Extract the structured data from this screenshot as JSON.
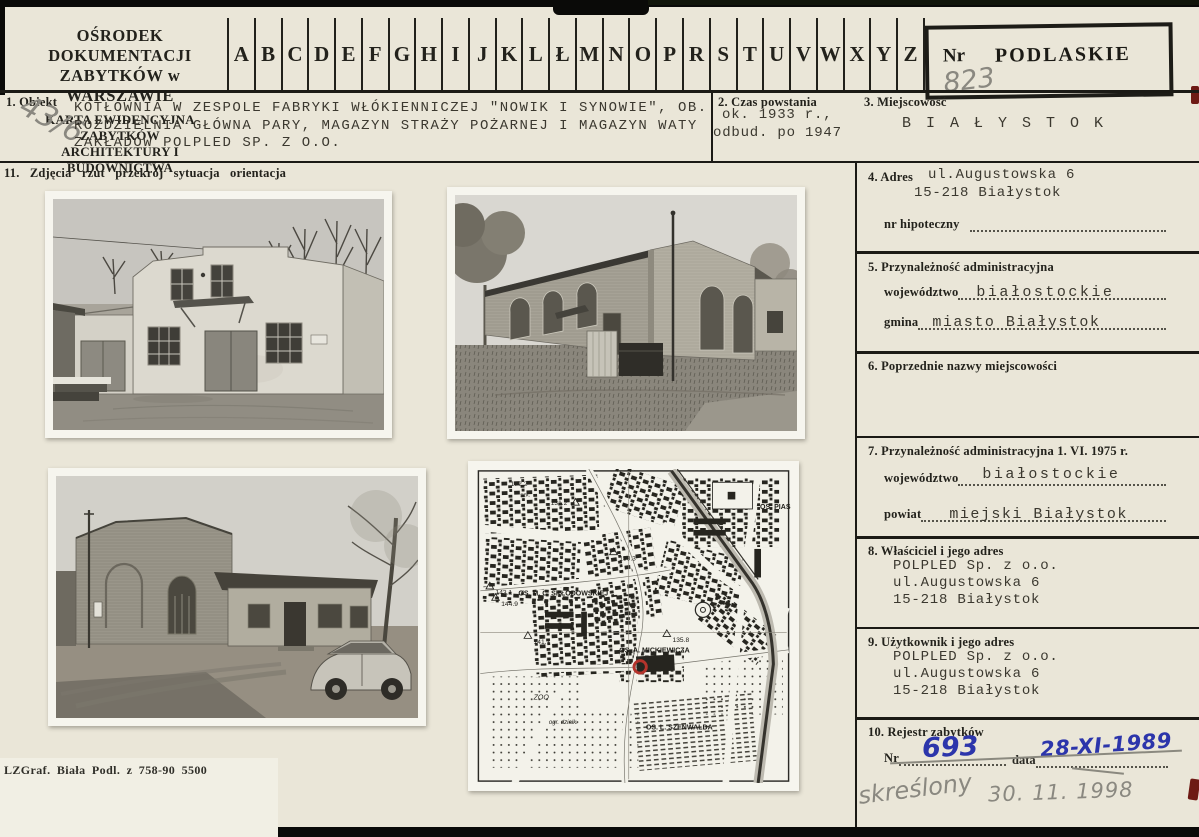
{
  "card": {
    "header": {
      "org_line1": "OŚRODEK DOKUMENTACJI",
      "org_line2": "ZABYTKÓW w WARSZAWIE",
      "type_line1": "KARTA EWIDENCYJNA ZABYTKÓW",
      "type_line2": "ARCHITEKTURY I BUDOWNICTWA",
      "alphabet": [
        "A",
        "B",
        "C",
        "D",
        "E",
        "F",
        "G",
        "H",
        "I",
        "J",
        "K",
        "L",
        "Ł",
        "M",
        "N",
        "O",
        "P",
        "R",
        "S",
        "T",
        "U",
        "V",
        "W",
        "X",
        "Y",
        "Z"
      ],
      "nr_label": "Nr",
      "nr_value": "823",
      "region_stamp": "PODLASKIE"
    },
    "section1": {
      "label": "1. Obiekt",
      "margin_note": "43/6",
      "line1": "KOTŁOWNIA W ZESPOLE FABRYKI WŁÓKIENNICZEJ \"NOWIK I SYNOWIE\", OB.",
      "line2": "ROZDZIELNIA GŁÓWNA PARY, MAGAZYN STRAŻY POŻARNEJ I MAGAZYN WATY",
      "line3": "ZAKŁADÓW POLPLED SP. Z O.O."
    },
    "section2": {
      "label": "2. Czas powstania",
      "value_line1": "ok. 1933 r.,",
      "value_line2": "odbud. po 1947"
    },
    "section3": {
      "label": "3. Miejscowość",
      "value": "B I A Ł Y S T O K"
    },
    "section4": {
      "label": "4. Adres",
      "value_line1": "ul.Augustowska 6",
      "value_line2": "15-218 Białystok",
      "hipoteczny_label": "nr hipoteczny"
    },
    "section5": {
      "label": "5. Przynależność administracyjna",
      "wojewodztwo_label": "województwo",
      "wojewodztwo_value": "białostockie",
      "gmina_label": "gmina",
      "gmina_value": "miasto Białystok"
    },
    "section6": {
      "label": "6. Poprzednie nazwy miejscowości"
    },
    "section7": {
      "label": "7. Przynależność administracyjna 1. VI. 1975 r.",
      "wojewodztwo_label": "województwo",
      "wojewodztwo_value": "białostockie",
      "powiat_label": "powiat",
      "powiat_value": "miejski Białystok"
    },
    "section8": {
      "label": "8. Właściciel i jego adres",
      "line1": "POLPLED Sp. z o.o.",
      "line2": "ul.Augustowska 6",
      "line3": "15-218 Białystok"
    },
    "section9": {
      "label": "9. Użytkownik i jego adres",
      "line1": "POLPLED Sp. z o.o.",
      "line2": "ul.Augustowska 6",
      "line3": "15-218 Białystok"
    },
    "section10": {
      "label": "10. Rejestr zabytków",
      "nr_label": "Nr",
      "nr_value": "693",
      "data_label": "data",
      "data_value": "28-XI-1989",
      "note": "skreślony",
      "note_date": "30. 11. 1998"
    },
    "section11": {
      "label": "11. Zdjęcia rzut przekrój sytuacja orientacja"
    },
    "footer": {
      "print_code": "LZGraf. Biała Podl. z 758-90 5500"
    },
    "map": {
      "labels": {
        "elev_132": "132.2",
        "szk": "szk.",
        "elev_131": "131.2",
        "elev_130": "130.3",
        "elev_143": "143.1",
        "elev_144": "144.9",
        "elev_141": "141.7",
        "elev_135": "135.8",
        "os_sklodowskiej": "OS. M. C. SKŁODOWSKIEJ",
        "os_mickiewicza": "OS. A. MICKIEWICZA",
        "os_szenwalda": "OS. L. SZENWALDA",
        "os_pias": "OS. PIAS",
        "zoo": "ZOO",
        "ogr": "ogr. działk."
      }
    },
    "colors": {
      "card_bg": "#eae6d8",
      "pen_blue": "#2c35ab",
      "pencil": "#8a8880",
      "marker_red": "#b5342c"
    }
  }
}
